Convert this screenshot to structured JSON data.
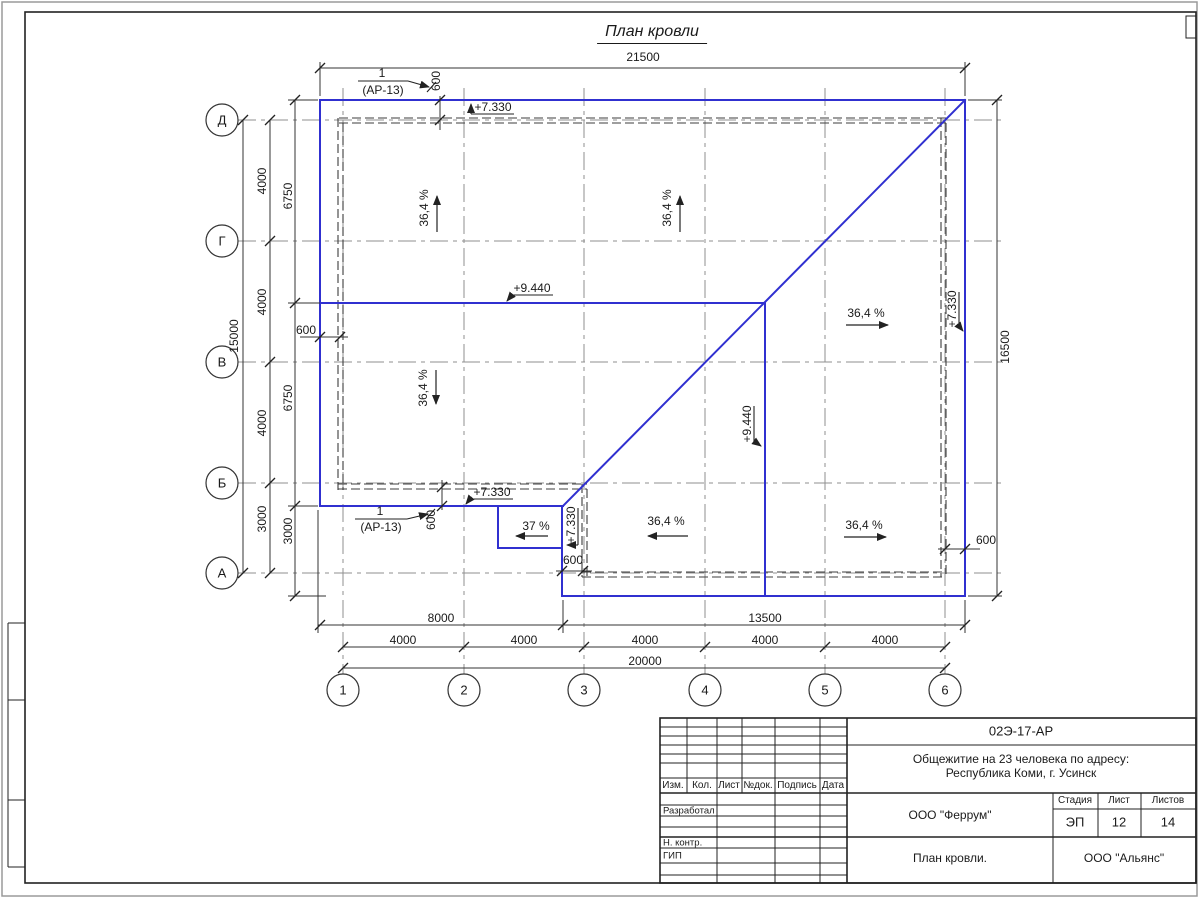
{
  "sheet": {
    "title": "План кровли"
  },
  "axes": {
    "letters": [
      "Д",
      "Г",
      "В",
      "Б",
      "А"
    ],
    "numbers": [
      "1",
      "2",
      "3",
      "4",
      "5",
      "6"
    ]
  },
  "dimensions": {
    "top_total": "21500",
    "right_total": "16500",
    "left_total": "15000",
    "left_spans": [
      "4000",
      "4000",
      "4000",
      "3000"
    ],
    "left_inner_spans": [
      "6750",
      "6750",
      "3000"
    ],
    "bottom_spans": [
      "8000",
      "13500"
    ],
    "bottom_axis_spans": [
      "4000",
      "4000",
      "4000",
      "4000",
      "4000"
    ],
    "bottom_total": "20000",
    "overhang": "600"
  },
  "annotations": {
    "slope_main": "36,4 %",
    "slope_small": "37 %",
    "elev_ridge": "+9.440",
    "elev_eave": "+7.330",
    "detail_num": "1",
    "detail_ref": "(АР-13)"
  },
  "title_block": {
    "doc_number": "02Э-17-АР",
    "project_line1": "Общежитие на 23 человека по адресу:",
    "project_line2": "Республика Коми, г. Усинск",
    "header_cols": [
      "Изм.",
      "Кол.",
      "Лист",
      "№док.",
      "Подпись",
      "Дата"
    ],
    "roles": [
      "Разработал",
      "Н. контр.",
      "ГИП"
    ],
    "company": "ООО \"Феррум\"",
    "stage_label": "Стадия",
    "sheet_label": "Лист",
    "sheets_label": "Листов",
    "stage": "ЭП",
    "sheet": "12",
    "sheets": "14",
    "drawing_title": "План кровли.",
    "contractor": "ООО \"Альянс\""
  }
}
